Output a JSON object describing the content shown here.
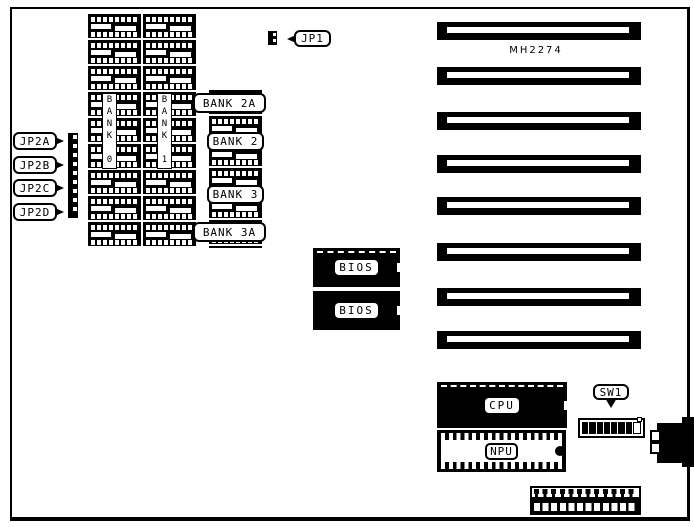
{
  "diagram": {
    "model_label": "MH2274",
    "jumpers": {
      "jp1": "JP1",
      "jp2a": "JP2A",
      "jp2b": "JP2B",
      "jp2c": "JP2C",
      "jp2d": "JP2D"
    },
    "memory_banks": {
      "bank0": "BANK 0",
      "bank1": "BANK 1",
      "bank2a": "BANK 2A",
      "bank2": "BANK 2",
      "bank3": "BANK 3",
      "bank3a": "BANK 3A"
    },
    "chips": {
      "bios_top": "BIOS",
      "bios_bottom": "BIOS",
      "cpu": "CPU",
      "npu": "NPU"
    },
    "switches": {
      "sw1": "SW1",
      "sw1_positions": 8,
      "sw1_closed_positions": 7
    },
    "expansion_slot_count": 8,
    "colors": {
      "ink": "#000000",
      "paper": "#ffffff"
    }
  }
}
